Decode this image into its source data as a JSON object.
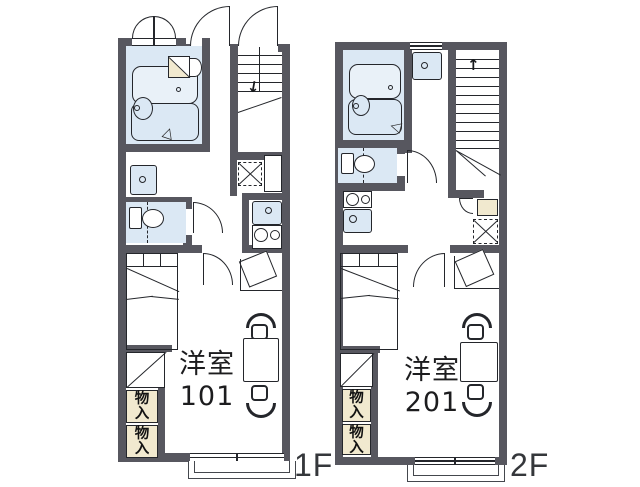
{
  "meta": {
    "type": "apartment-floor-plan",
    "units": 2
  },
  "colors": {
    "wall": "#57575f",
    "line": "#24262b",
    "water": "#dbe8f4",
    "cream": "#f1e9cf",
    "ink": "#1c1c1e",
    "balcony": "#44474d"
  },
  "glyphs": {
    "stair_arrow_down": "↓",
    "stair_arrow_up": "↑",
    "door_mark": "△"
  },
  "floors": [
    {
      "label": "1F",
      "room": {
        "name": "洋室",
        "number": "101"
      },
      "storages": [
        "物入",
        "物入"
      ]
    },
    {
      "label": "2F",
      "room": {
        "name": "洋室",
        "number": "201"
      },
      "storages": [
        "物入",
        "物入"
      ]
    }
  ]
}
